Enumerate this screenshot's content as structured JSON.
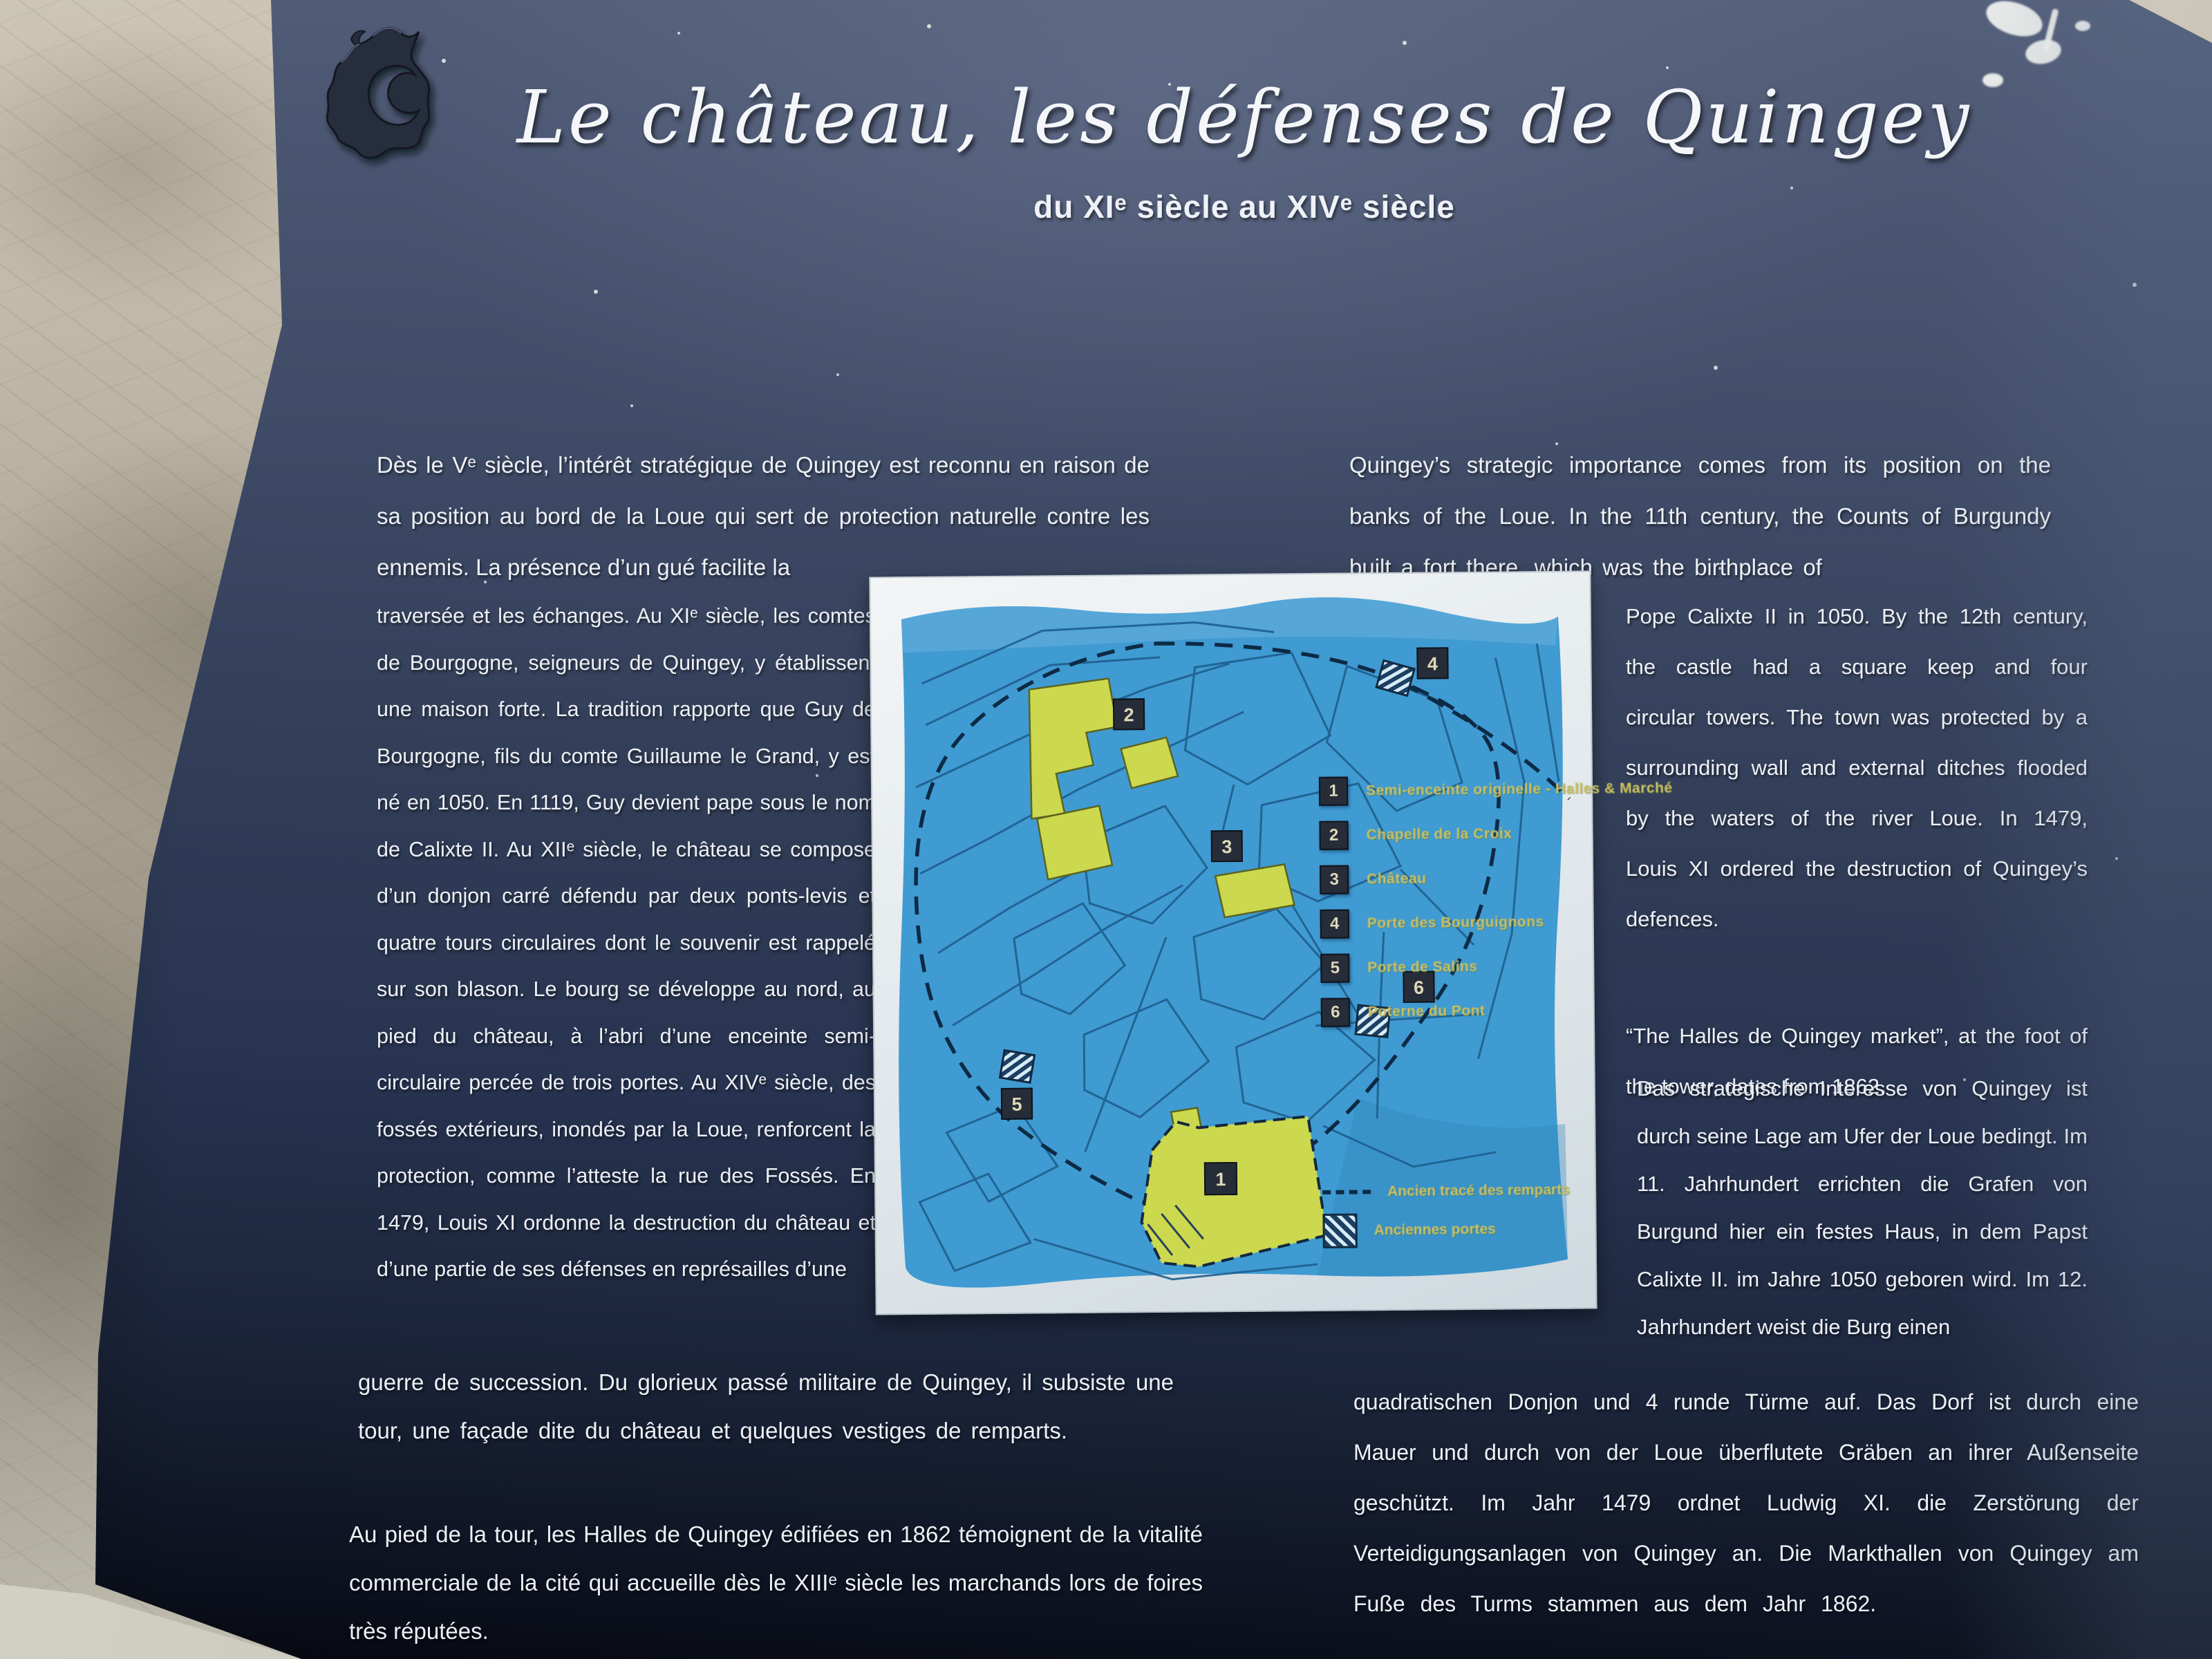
{
  "panel": {
    "title": "Le château, les défenses de Quingey",
    "subtitle": "du XIᵉ siècle au XIVᵉ siècle"
  },
  "french": {
    "p1": "Dès le Vᵉ siècle, l’intérêt stratégique de Quingey est reconnu en raison de sa position au bord de la Loue qui sert de protection naturelle contre les ennemis. La présence d’un gué facilite la",
    "p2": "traversée et les échanges. Au XIᵉ siècle, les comtes de Bourgogne, seigneurs de Quingey, y établissent une maison forte. La tradition rapporte que Guy de Bourgogne, fils du comte Guillaume le Grand, y est né en 1050. En 1119, Guy devient pape sous le nom de Calixte II. Au XIIᵉ siècle, le château se compose d’un donjon carré défendu par deux ponts-levis et quatre tours circulaires dont le souvenir est rappelé sur son blason. Le bourg se développe au nord, au pied du château, à l’abri d’une enceinte semi-circulaire percée de trois portes. Au XIVᵉ siècle, des fossés extérieurs, inondés par la Loue, renforcent la protection, comme l’atteste la rue des Fossés. En 1479, Louis XI ordonne la destruction du château et d’une partie de ses défenses en représailles d’une",
    "p3": "guerre de succession. Du glorieux passé militaire de Quingey, il subsiste une tour, une façade dite du château et quelques vestiges de remparts.",
    "p4": "Au pied de la tour, les Halles de Quingey édifiées en 1862 témoignent de la vitalité commerciale de la cité qui accueille dès le XIIIᵉ siècle les marchands lors de foires très réputées."
  },
  "english": {
    "p1": "Quingey’s strategic importance comes from its position on the banks of the Loue. In the 11th century, the Counts of Burgundy built a fort there, which was the birthplace of",
    "p2": "Pope Calixte II in 1050. By the 12th century, the castle had a square keep and four circular towers. The town was protected by a surrounding wall and external ditches flooded by the waters of the river Loue. In 1479, Louis XI ordered the destruction of Quingey’s defences.",
    "p3": "“The Halles de Quingey market”, at the foot of the tower, dates from 1862."
  },
  "german": {
    "p1": "Das strategische Interesse von Quingey ist durch seine Lage am Ufer der Loue bedingt. Im 11. Jahrhundert errichten die Grafen von Burgund hier ein festes Haus, in dem Papst Calixte II. im Jahre 1050 geboren wird. Im 12. Jahrhundert weist die Burg einen",
    "p2": "quadratischen Donjon und 4 runde Türme auf. Das Dorf ist durch eine Mauer und durch von der Loue überflutete Gräben an ihrer Außenseite geschützt. Im Jahr 1479 ordnet Ludwig XI. die Zerstörung der Verteidigungsanlagen von Quingey an. Die Markthallen von Quingey am Fuße des Turms stammen aus dem Jahr 1862."
  },
  "map": {
    "items": [
      {
        "num": "1",
        "label": "Semi-enceinte originelle - Halles & Marché"
      },
      {
        "num": "2",
        "label": "Chapelle de la Croix"
      },
      {
        "num": "3",
        "label": "Château"
      },
      {
        "num": "4",
        "label": "Porte des Bourguignons"
      },
      {
        "num": "5",
        "label": "Porte de Salins"
      },
      {
        "num": "6",
        "label": "Poterne du Pont"
      }
    ],
    "rampart_label": "Ancien tracé des remparts",
    "gates_label": "Anciennes portes",
    "colors": {
      "map_blue": "#3f9bd2",
      "building_yellow": "#ccd84e",
      "legend_text": "#cfc063",
      "panel_top": "#515c74",
      "panel_bottom": "#0e1320"
    }
  }
}
